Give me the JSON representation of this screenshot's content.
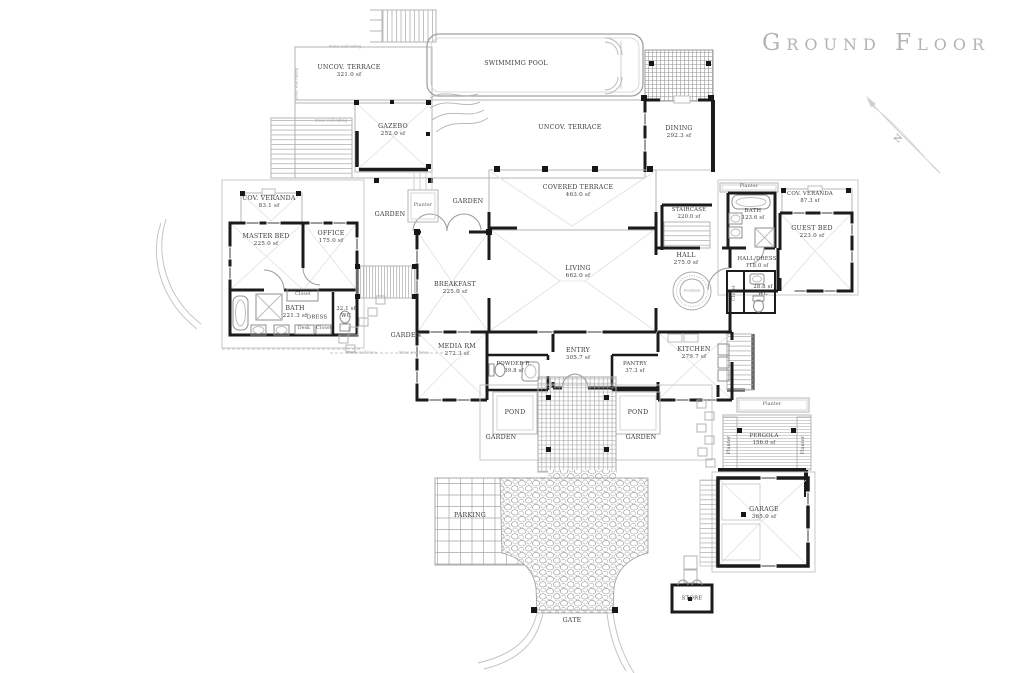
{
  "title": "Ground Floor",
  "compass": {
    "north_label": "N"
  },
  "rooms": [
    {
      "name": "UNCOV. TERRACE",
      "area": "321.0 sf"
    },
    {
      "name": "SWIMMIMG POOL",
      "area": ""
    },
    {
      "name": "GAZEBO",
      "area": "252.0 sf"
    },
    {
      "name": "UNCOV. TERRACE",
      "area": ""
    },
    {
      "name": "DINING",
      "area": "292.3 sf"
    },
    {
      "name": "COV. VERANDA",
      "area": "83.1 sf"
    },
    {
      "name": "MASTER BED",
      "area": "225.0 sf"
    },
    {
      "name": "OFFICE",
      "area": "175.0 sf"
    },
    {
      "name": "COVERED TERRACE",
      "area": "463.0 sf"
    },
    {
      "name": "STAIRCASE",
      "area": "220.0 sf"
    },
    {
      "name": "BATH",
      "area": "123.6 sf"
    },
    {
      "name": "COV. VERANDA",
      "area": "87.3 sf"
    },
    {
      "name": "GUEST BED",
      "area": "223.0 sf"
    },
    {
      "name": "HALL",
      "area": "275.0 sf"
    },
    {
      "name": "HALL/DRESS",
      "area": "118.0 sf"
    },
    {
      "name": "LIVING",
      "area": "662.0 sf"
    },
    {
      "name": "BREAKFAST",
      "area": "225.0 sf"
    },
    {
      "name": "BATH",
      "area": "221.3 sf"
    },
    {
      "name": "WC",
      "area": "32.1 sf"
    },
    {
      "name": "WC",
      "area": "28.8 sf"
    },
    {
      "name": "MEDIA RM",
      "area": "272.3 sf"
    },
    {
      "name": "ENTRY",
      "area": "305.7 sf"
    },
    {
      "name": "POWDER R.",
      "area": "39.8 sf"
    },
    {
      "name": "PANTRY",
      "area": "37.3 sf"
    },
    {
      "name": "KITCHEN",
      "area": "279.7 sf"
    },
    {
      "name": "PERGOLA",
      "area": "156.0 sf"
    },
    {
      "name": "GARAGE",
      "area": "365.0 sf"
    }
  ],
  "labels": {
    "garden": "GARDEN",
    "planter": "Planter",
    "pond": "POND",
    "parking": "PARKING",
    "store": "STORE",
    "gate": "GATE",
    "dress": "DRESS",
    "desk": "Desk",
    "closet": "Closet",
    "fountain": "Fountain",
    "stone_wall_railing": "Stone wall railing",
    "stone_wall_fence": "Stone wall fence"
  },
  "colors": {
    "wall": "#1b1b1b",
    "outline": "#b4b4b4",
    "faint": "#e0e0e0",
    "text": "#3c3c3c",
    "title": "#b4b4b4"
  }
}
